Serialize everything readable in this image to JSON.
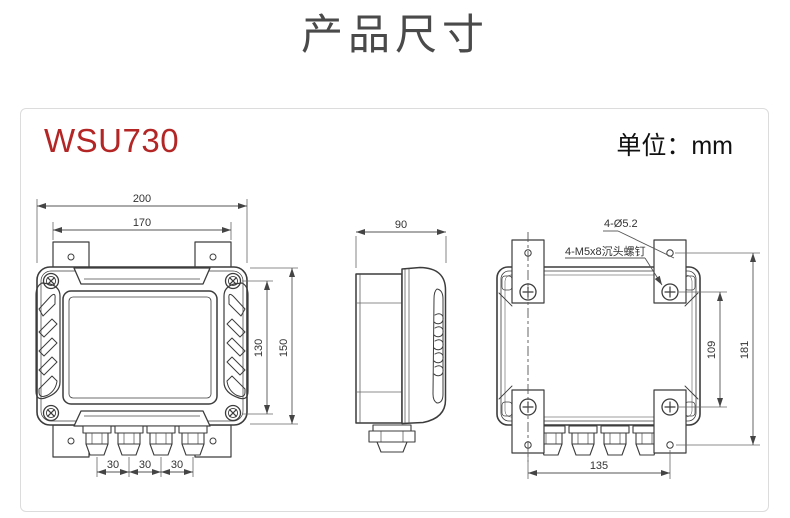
{
  "title": "产品尺寸",
  "panel": {
    "model": "WSU730",
    "unit": "单位：mm"
  },
  "views": {
    "front": {
      "dims": {
        "outer_width": "200",
        "bracket_width": "170",
        "screw_spacing_v": "130",
        "body_height": "150",
        "gland_pitch": [
          "30",
          "30",
          "30"
        ]
      }
    },
    "side": {
      "dims": {
        "depth": "90"
      }
    },
    "rear": {
      "labels": {
        "holes": "4-Ø5.2",
        "screws": "4-M5x8沉头螺钉"
      },
      "dims": {
        "screw_spacing_v": "109",
        "hole_spacing_v": "181",
        "hole_spacing_h": "135"
      }
    }
  },
  "colors": {
    "accent_red": "#b42626",
    "title_gray": "#4a4a4a",
    "line": "#3c3c3c",
    "panel_border": "#dcdcdc"
  }
}
